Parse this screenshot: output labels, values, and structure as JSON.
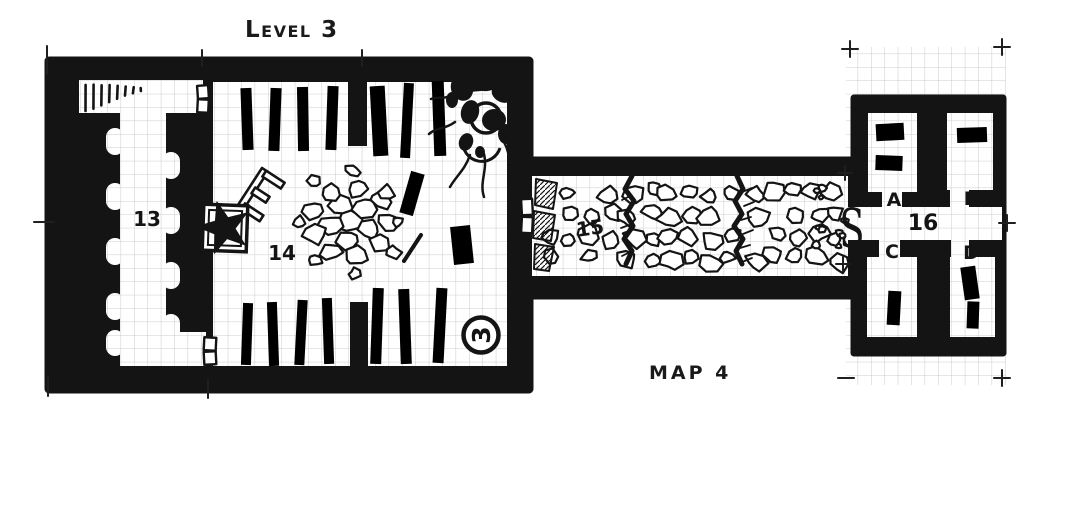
{
  "canvas": {
    "width": 1082,
    "height": 527
  },
  "colors": {
    "paper": "#ffffff",
    "ink": "#141414",
    "grid": "#cccccc"
  },
  "titles": {
    "level_label": "Level 3",
    "map_label": "Map 4"
  },
  "rooms": [
    {
      "number": "13"
    },
    {
      "number": "14"
    },
    {
      "number": "15"
    },
    {
      "number": "16"
    }
  ],
  "subrooms": [
    {
      "letter": "A"
    },
    {
      "letter": "B"
    },
    {
      "letter": "C"
    },
    {
      "letter": "D"
    }
  ],
  "markers": {
    "secret_door": "S",
    "level_connector": "3"
  }
}
